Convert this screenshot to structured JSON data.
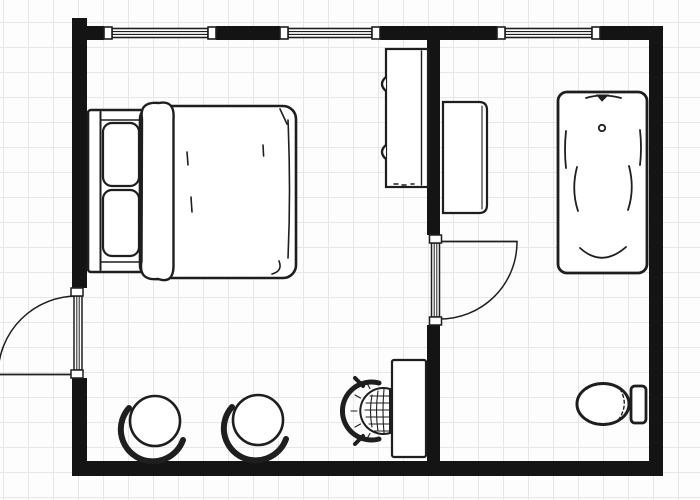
{
  "document": {
    "type": "architectural floor plan",
    "style": "black-and-white line drawing on light grid paper",
    "visible_text": "",
    "rooms_summary": "Bedroom (left) with en-suite Bathroom (right)"
  },
  "canvas": {
    "width_px": 700,
    "height_px": 500,
    "background_color": "#fdfdfd",
    "grid_color": "#e7e7e7",
    "grid_spacing_px": 25,
    "wall_color": "#141414",
    "line_color": "#1e1e1e",
    "fill_color": "#ffffff"
  },
  "floorplan": {
    "rooms": [
      {
        "name": "Bedroom",
        "side": "left",
        "furniture": [
          "double-bed",
          "round-chair-1",
          "round-chair-2",
          "wardrobe",
          "dressing-table",
          "wicker-stool"
        ]
      },
      {
        "name": "Bathroom",
        "side": "right",
        "furniture": [
          "bathroom-cabinet",
          "bathtub",
          "toilet"
        ]
      }
    ],
    "walls": [
      {
        "id": "top-wall-segment-1",
        "orientation": "horizontal",
        "bbox_px": [
          87,
          26,
          17,
          14
        ]
      },
      {
        "id": "top-wall-segment-2",
        "orientation": "horizontal",
        "bbox_px": [
          216,
          26,
          64,
          14
        ]
      },
      {
        "id": "top-wall-segment-3",
        "orientation": "horizontal",
        "bbox_px": [
          380,
          26,
          117,
          14
        ]
      },
      {
        "id": "top-wall-segment-4",
        "orientation": "horizontal",
        "bbox_px": [
          600,
          26,
          63,
          14
        ]
      },
      {
        "id": "left-wall-upper",
        "orientation": "vertical",
        "bbox_px": [
          72,
          18,
          15,
          270
        ]
      },
      {
        "id": "left-wall-lower",
        "orientation": "vertical",
        "bbox_px": [
          72,
          378,
          15,
          98
        ]
      },
      {
        "id": "right-wall",
        "orientation": "vertical",
        "bbox_px": [
          649,
          26,
          14,
          450
        ]
      },
      {
        "id": "bottom-wall",
        "orientation": "horizontal",
        "bbox_px": [
          72,
          461,
          591,
          15
        ]
      },
      {
        "id": "interior-wall-upper",
        "orientation": "vertical",
        "bbox_px": [
          427,
          38,
          13,
          197
        ]
      },
      {
        "id": "interior-wall-lower",
        "orientation": "vertical",
        "bbox_px": [
          427,
          325,
          13,
          136
        ]
      }
    ],
    "windows": [
      {
        "id": "window-1",
        "wall": "top",
        "span_px": [
          104,
          216
        ]
      },
      {
        "id": "window-2",
        "wall": "top",
        "span_px": [
          280,
          380
        ]
      },
      {
        "id": "window-3",
        "wall": "top",
        "span_px": [
          497,
          600
        ]
      }
    ],
    "doors": [
      {
        "id": "entry-door",
        "wall": "left-exterior",
        "gap_px": [
          288,
          378
        ],
        "hinge": "bottom",
        "swing": "outward to the left",
        "shown": "closed panel plus quarter-circle swing arc"
      },
      {
        "id": "bathroom-door",
        "wall": "interior",
        "gap_px": [
          235,
          325
        ],
        "hinge": "top",
        "swing": "into bathroom (right)",
        "shown": "closed panel plus quarter-circle swing arc"
      }
    ],
    "furniture": [
      {
        "id": "double-bed",
        "room": "Bedroom",
        "bbox_px": [
          88,
          103,
          208,
          178
        ],
        "parts": [
          "headboard",
          "pillow-top",
          "pillow-bottom",
          "folded-sheet",
          "duvet"
        ]
      },
      {
        "id": "round-chair-1",
        "room": "Bedroom",
        "center_px": [
          155,
          421
        ],
        "radius_px": 25,
        "detail": "circular seat with wrap-around back"
      },
      {
        "id": "round-chair-2",
        "room": "Bedroom",
        "center_px": [
          258,
          420
        ],
        "radius_px": 25,
        "detail": "circular seat with wrap-around back"
      },
      {
        "id": "wardrobe",
        "room": "Bedroom",
        "bbox_px": [
          386,
          49,
          42,
          138
        ],
        "detail": "tall hinged cabinet against interior wall, two hinges on left edge"
      },
      {
        "id": "dressing-table",
        "room": "Bedroom",
        "bbox_px": [
          392,
          360,
          34,
          97
        ]
      },
      {
        "id": "wicker-stool",
        "room": "Bedroom",
        "bbox_px": [
          352,
          376,
          40,
          70
        ],
        "detail": "woven round-back stool facing dressing table"
      },
      {
        "id": "bathroom-cabinet",
        "room": "Bathroom",
        "bbox_px": [
          443,
          102,
          44,
          111
        ]
      },
      {
        "id": "bathtub",
        "room": "Bathroom",
        "bbox_px": [
          558,
          92,
          89,
          181
        ],
        "parts": [
          "faucet",
          "drain"
        ]
      },
      {
        "id": "toilet",
        "room": "Bathroom",
        "bbox_px": [
          578,
          384,
          68,
          41
        ],
        "parts": [
          "bowl",
          "tank"
        ]
      }
    ]
  }
}
